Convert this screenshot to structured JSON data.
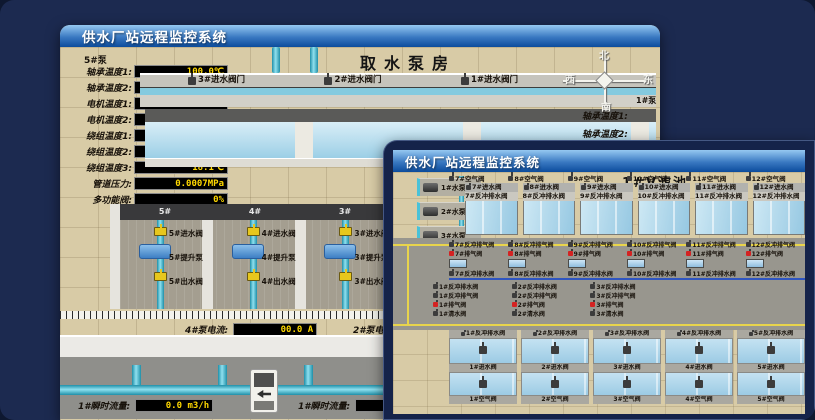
{
  "back_window": {
    "title": "供水厂站远程监控系统",
    "scene_title": "取水泵房",
    "pump_group_label": "5#泵",
    "readouts": [
      {
        "label": "轴承温度1:",
        "value": "100.0℃"
      },
      {
        "label": "轴承温度2:",
        "value": "100.0℃"
      },
      {
        "label": "电机温度1:",
        "value": "18.1℃"
      },
      {
        "label": "电机温度2:",
        "value": "17.9℃"
      },
      {
        "label": "绕组温度1:",
        "value": "18.0℃"
      },
      {
        "label": "绕组温度2:",
        "value": "18.1℃"
      },
      {
        "label": "绕组温度3:",
        "value": "18.1℃"
      },
      {
        "label": "管道压力:",
        "value": "0.0007MPa"
      },
      {
        "label": "多功能阀:",
        "value": "0%"
      }
    ],
    "inlet_gate_valves": [
      "3#进水阀门",
      "2#进水阀门",
      "1#进水阀门"
    ],
    "pump_bays": [
      {
        "bay": "5#",
        "inlet": "5#进水阀",
        "pump": "5#提升泵",
        "outlet": "5#出水阀"
      },
      {
        "bay": "4#",
        "inlet": "4#进水阀",
        "pump": "4#提升泵",
        "outlet": "4#出水阀"
      },
      {
        "bay": "3#",
        "inlet": "3#进水阀",
        "pump": "3#提升泵",
        "outlet": "3#出水阀"
      },
      {
        "bay": "2#",
        "inlet": "2#进水阀",
        "pump": "2#提升泵",
        "outlet": "2#出水阀"
      }
    ],
    "current_left": {
      "label": "4#泵电流:",
      "value": "00.0 A"
    },
    "current_right": {
      "label": "2#泵电流:"
    },
    "flow_left": {
      "label": "1#瞬时流量:",
      "value": "0.0 m3/h"
    },
    "flow_right": {
      "label": "1#瞬时流量:",
      "value": "0.0 m3/"
    },
    "compass": {
      "north": "北",
      "south": "南",
      "west": "西",
      "east": "东"
    },
    "right_partial": {
      "pump_label": "1#泵",
      "labels": [
        "轴承温度1:",
        "轴承温度2:"
      ]
    }
  },
  "front_window": {
    "title": "供水厂站远程监控系统",
    "scene_title": "1#V滤池",
    "water_pumps": [
      "1#水泵",
      "2#水泵",
      "3#水泵"
    ],
    "blowers": [
      "1#风机",
      "2#风机",
      "3#风机"
    ],
    "top_cells": [
      {
        "air": "7#空气阀",
        "inlet": "7#进水阀",
        "drain": "7#反冲排水阀"
      },
      {
        "air": "8#空气阀",
        "inlet": "8#进水阀",
        "drain": "8#反冲排水阀"
      },
      {
        "air": "9#空气阀",
        "inlet": "9#进水阀",
        "drain": "9#反冲排水阀"
      },
      {
        "air": "10#空气阀",
        "inlet": "10#进水阀",
        "drain": "10#反冲排水阀"
      },
      {
        "air": "11#空气阀",
        "inlet": "11#进水阀",
        "drain": "11#反冲排水阀"
      },
      {
        "air": "12#空气阀",
        "inlet": "12#进水阀",
        "drain": "12#反冲排水阀"
      }
    ],
    "mid_top_valves": [
      {
        "backwash_air": "7#反冲排气阀",
        "exhaust": "7#排气阀",
        "backwash_drain": "7#反冲排水阀"
      },
      {
        "backwash_air": "8#反冲排气阀",
        "exhaust": "8#排气阀",
        "backwash_drain": "8#反冲排水阀"
      },
      {
        "backwash_air": "9#反冲排气阀",
        "exhaust": "9#排气阀",
        "backwash_drain": "9#反冲排水阀"
      },
      {
        "backwash_air": "10#反冲排气阀",
        "exhaust": "10#排气阀",
        "backwash_drain": "10#反冲排水阀"
      },
      {
        "backwash_air": "11#反冲排气阀",
        "exhaust": "11#排气阀",
        "backwash_drain": "11#反冲排水阀"
      },
      {
        "backwash_air": "12#反冲排气阀",
        "exhaust": "12#排气阀",
        "backwash_drain": "12#反冲排水阀"
      }
    ],
    "mid_bottom_valves": [
      {
        "backwash_drain": "1#反冲排水阀",
        "backwash_air": "1#反冲排气阀",
        "exhaust": "1#排气阀",
        "clean": "1#清水阀"
      },
      {
        "backwash_drain": "2#反冲排水阀",
        "backwash_air": "2#反冲排气阀",
        "exhaust": "2#排气阀",
        "clean": "2#清水阀"
      },
      {
        "backwash_drain": "3#反冲排水阀",
        "backwash_air": "3#反冲排气阀",
        "exhaust": "3#排气阀",
        "clean": "3#清水阀"
      }
    ],
    "bottom_cells": [
      {
        "drain": "1#反冲排水阀",
        "inlet": "1#进水阀",
        "air": "1#空气阀"
      },
      {
        "drain": "2#反冲排水阀",
        "inlet": "2#进水阀",
        "air": "2#空气阀"
      },
      {
        "drain": "3#反冲排水阀",
        "inlet": "3#进水阀",
        "air": "3#空气阀"
      },
      {
        "drain": "4#反冲排水阀",
        "inlet": "4#进水阀",
        "air": "4#空气阀"
      },
      {
        "drain": "5#反冲排水阀",
        "inlet": "5#进水阀",
        "air": "5#空气阀"
      }
    ]
  }
}
